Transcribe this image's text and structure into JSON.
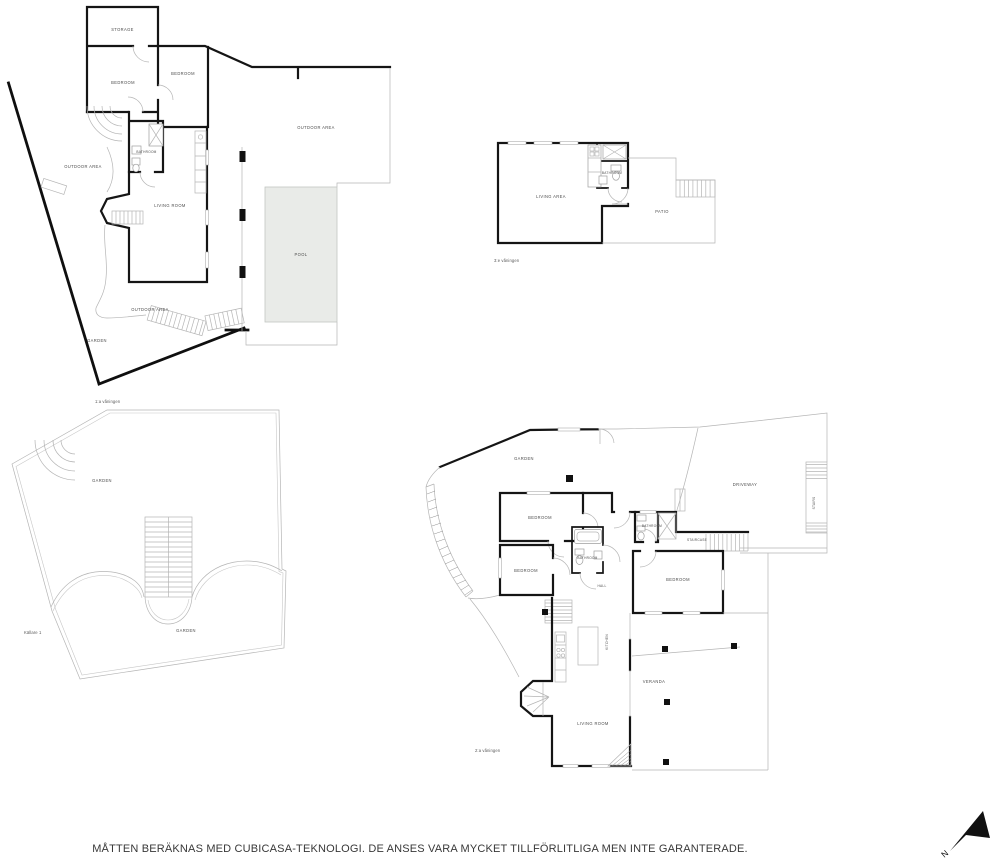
{
  "disclaimer": "MÅTTEN BERÄKNAS MED CUBICASA-TEKNOLOGI. DE ANSES VARA MYCKET TILLFÖRLITLIGA MEN INTE GARANTERADE.",
  "compass": {
    "north": "N"
  },
  "floor1": {
    "name": "1:a våningen",
    "storage": "STORAGE",
    "bedroom_left": "BEDROOM",
    "bedroom_right": "BEDROOM",
    "bathroom": "BATHROOM",
    "living_room": "LIVING ROOM",
    "outdoor_left": "OUTDOOR AREA",
    "outdoor_right": "OUTDOOR AREA",
    "outdoor_bottom": "OUTDOOR AREA",
    "garden": "GARDEN",
    "pool": "POOL"
  },
  "floor3": {
    "name": "3:e våningen",
    "living_area": "LIVING AREA",
    "bathroom": "BATHROOM",
    "patio": "PATIO"
  },
  "basement": {
    "name": "Källare 1",
    "garden_upper": "GARDEN",
    "garden_lower": "GARDEN"
  },
  "floor2": {
    "name": "2:a våningen",
    "garden": "GARDEN",
    "bedroom_top": "BEDROOM",
    "bedroom_left": "BEDROOM",
    "bedroom_right": "BEDROOM",
    "bathroom_mid": "BATHROOM",
    "bathroom_top": "BATHROOM",
    "hall": "HALL",
    "staircase": "STAIRCASE",
    "stairs": "STAIRS",
    "driveway": "DRIVEWAY",
    "kitchen": "KITCHEN",
    "veranda": "VERANDA",
    "living_room": "LIVING ROOM"
  },
  "colors": {
    "wall": "#151515",
    "thin_line": "#b5b5b5",
    "pool_fill": "#e9ebe8",
    "label": "#4c4c4c"
  }
}
